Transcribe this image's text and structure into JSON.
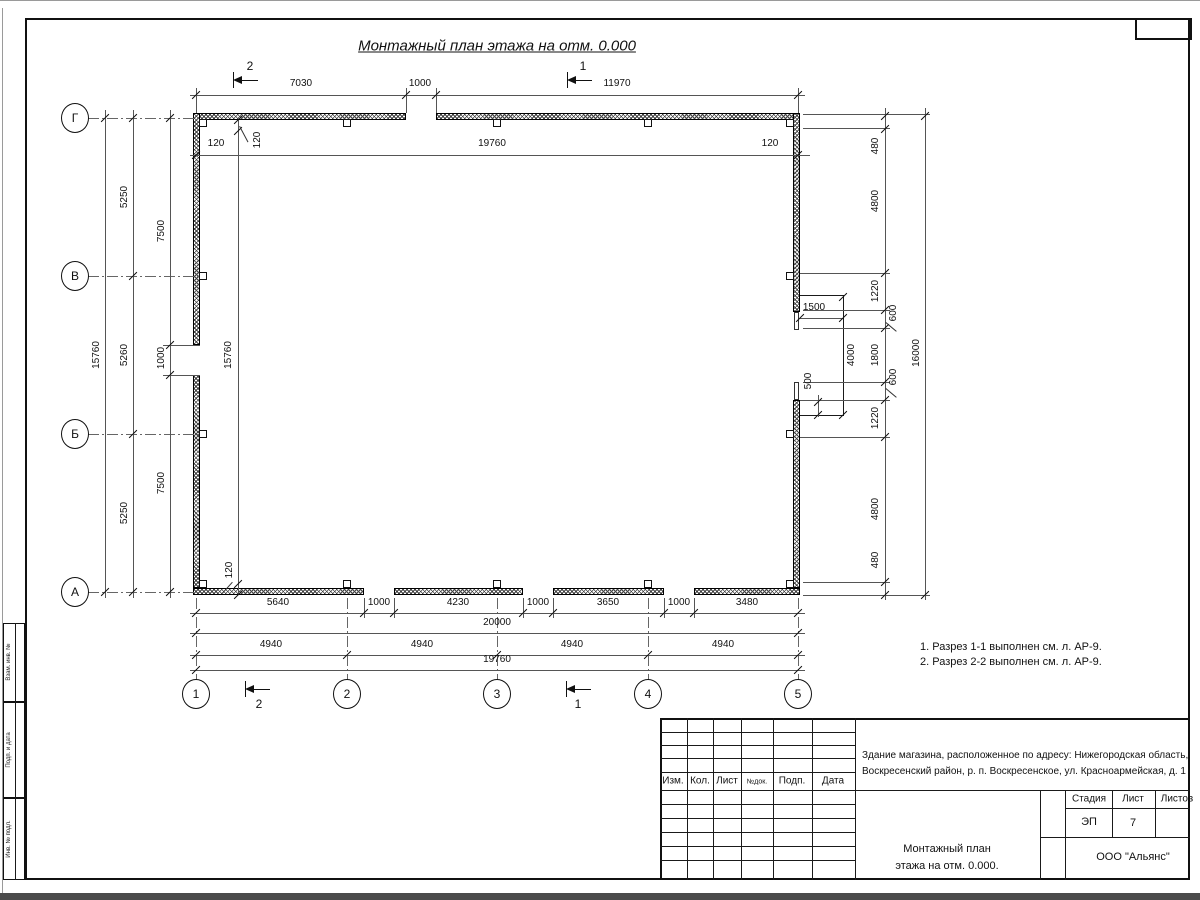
{
  "drawing": {
    "title": "Монтажный план этажа на отм. 0.000",
    "notes": [
      "1. Разрез 1-1 выполнен см. л. АР-9.",
      "2. Разрез 2-2 выполнен см. л. АР-9."
    ],
    "axes": {
      "rows": [
        "Г",
        "В",
        "Б",
        "А"
      ],
      "cols": [
        "1",
        "2",
        "3",
        "4",
        "5"
      ]
    },
    "sections": {
      "s1": "1",
      "s2": "2"
    },
    "dims": {
      "top": [
        "7030",
        "1000",
        "11970"
      ],
      "top_inner": [
        "120",
        "19760",
        "120"
      ],
      "left_total": "15760",
      "left_spans": [
        "5250",
        "5260",
        "5250"
      ],
      "left_openings": [
        "7500",
        "1000",
        "7500"
      ],
      "left_inner": [
        "120",
        "15760",
        "120"
      ],
      "right_chain": [
        "480",
        "4800",
        "1220",
        "600",
        "1800",
        "600",
        "1220",
        "4800",
        "480"
      ],
      "right_total": "16000",
      "dock": {
        "w": "1500",
        "h": "4000",
        "offset": "500"
      },
      "bottom_openings": [
        "5640",
        "1000",
        "4230",
        "1000",
        "3650",
        "1000",
        "3480"
      ],
      "bottom_total": "20000",
      "bottom_spans": [
        "4940",
        "4940",
        "4940",
        "4940"
      ],
      "bottom_inner": "19760"
    }
  },
  "titleblock": {
    "rev_cols": [
      "Изм.",
      "Кол.",
      "Лист",
      "№док.",
      "Подп.",
      "Дата"
    ],
    "project_line1": "Здание магазина, расположенное по адресу: Нижегородская область,",
    "project_line2": "Воскресенский район, р. п. Воскресенское, ул. Красноармейская, д. 1",
    "stage_label": "Стадия",
    "sheet_label": "Лист",
    "sheets_label": "Листов",
    "stage_value": "ЭП",
    "sheet_value": "7",
    "doc_line1": "Монтажный план",
    "doc_line2": "этажа на отм. 0.000.",
    "org": "ООО \"Альянс\""
  },
  "side_stamp": {
    "labels": [
      "Взам. инв. №",
      "Подп. и дата",
      "Инв. № подл."
    ]
  }
}
